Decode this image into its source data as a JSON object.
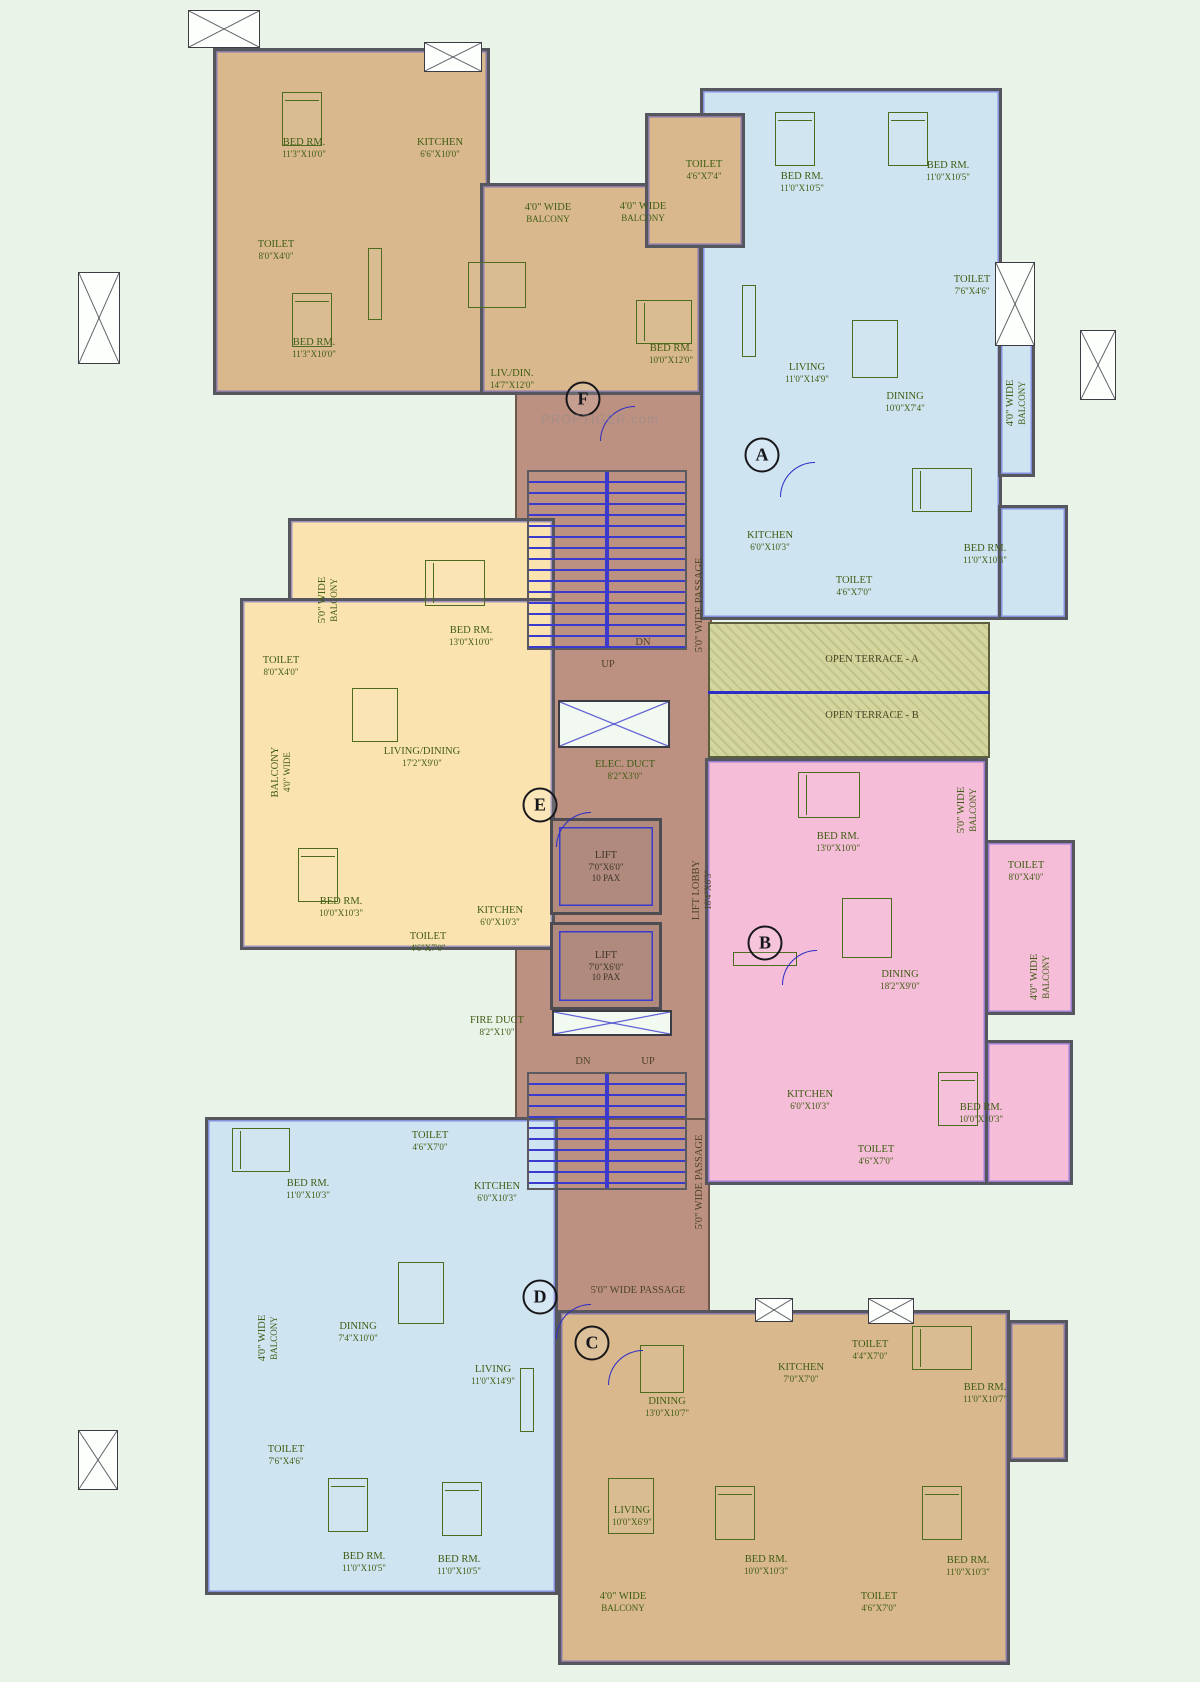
{
  "watermark": "PROPTIGER.com",
  "terraces": {
    "t1": "OPEN TERRACE - A",
    "t2": "OPEN TERRACE - B"
  },
  "core": {
    "passage": "5'0\" WIDE PASSAGE",
    "up": "UP",
    "dn": "DN",
    "lift": {
      "n": "LIFT",
      "d": "7'0\"X6'0\"",
      "c": "10 PAX"
    },
    "lift_lobby": {
      "n": "LIFT LOBBY",
      "d": "18'4\"X6'3\""
    },
    "elec_duct": {
      "n": "ELEC. DUCT",
      "d": "8'2\"X3'0\""
    },
    "fire_duct": {
      "n": "FIRE DUCT",
      "d": "8'2\"X1'0\""
    }
  },
  "units": {
    "a": {
      "letter": "A",
      "rooms": {
        "bed1": {
          "n": "BED RM.",
          "d": "11'0\"X10'5\""
        },
        "bed2": {
          "n": "BED RM.",
          "d": "11'0\"X10'5\""
        },
        "toilet1": {
          "n": "TOILET",
          "d": "7'6\"X4'6\""
        },
        "living": {
          "n": "LIVING",
          "d": "11'0\"X14'9\""
        },
        "dining": {
          "n": "DINING",
          "d": "10'0\"X7'4\""
        },
        "balcony": {
          "n": "4'0\" WIDE",
          "d": "BALCONY"
        },
        "kitchen": {
          "n": "KITCHEN",
          "d": "6'0\"X10'3\""
        },
        "toilet2": {
          "n": "TOILET",
          "d": "4'6\"X7'0\""
        },
        "bed3": {
          "n": "BED RM.",
          "d": "11'0\"X10'3\""
        }
      }
    },
    "b": {
      "letter": "B",
      "rooms": {
        "bed1": {
          "n": "BED RM.",
          "d": "13'0\"X10'0\""
        },
        "balcony1": {
          "n": "5'0\" WIDE",
          "d": "BALCONY"
        },
        "toilet1": {
          "n": "TOILET",
          "d": "8'0\"X4'0\""
        },
        "dining": {
          "n": "DINING",
          "d": "18'2\"X9'0\""
        },
        "balcony2": {
          "n": "4'0\" WIDE",
          "d": "BALCONY"
        },
        "kitchen": {
          "n": "KITCHEN",
          "d": "6'0\"X10'3\""
        },
        "toilet2": {
          "n": "TOILET",
          "d": "4'6\"X7'0\""
        },
        "bed2": {
          "n": "BED RM.",
          "d": "10'0\"X10'3\""
        }
      }
    },
    "c": {
      "letter": "C",
      "rooms": {
        "dining": {
          "n": "DINING",
          "d": "13'0\"X10'7\""
        },
        "kitchen": {
          "n": "KITCHEN",
          "d": "7'0\"X7'0\""
        },
        "toilet1": {
          "n": "TOILET",
          "d": "4'4\"X7'0\""
        },
        "bed1": {
          "n": "BED RM.",
          "d": "11'0\"X10'7\""
        },
        "living": {
          "n": "LIVING",
          "d": "10'0\"X6'9\""
        },
        "balcony": {
          "n": "4'0\" WIDE",
          "d": "BALCONY"
        },
        "bed2": {
          "n": "BED RM.",
          "d": "10'0\"X10'3\""
        },
        "toilet2": {
          "n": "TOILET",
          "d": "4'6\"X7'0\""
        },
        "bed3": {
          "n": "BED RM.",
          "d": "11'0\"X10'3\""
        }
      }
    },
    "d": {
      "letter": "D",
      "rooms": {
        "bed1": {
          "n": "BED RM.",
          "d": "11'0\"X10'3\""
        },
        "toilet1": {
          "n": "TOILET",
          "d": "4'6\"X7'0\""
        },
        "kitchen": {
          "n": "KITCHEN",
          "d": "6'0\"X10'3\""
        },
        "dining": {
          "n": "DINING",
          "d": "7'4\"X10'0\""
        },
        "balcony": {
          "n": "4'0\" WIDE",
          "d": "BALCONY"
        },
        "living": {
          "n": "LIVING",
          "d": "11'0\"X14'9\""
        },
        "toilet2": {
          "n": "TOILET",
          "d": "7'6\"X4'6\""
        },
        "bed2": {
          "n": "BED RM.",
          "d": "11'0\"X10'5\""
        },
        "bed3": {
          "n": "BED RM.",
          "d": "11'0\"X10'5\""
        }
      }
    },
    "e": {
      "letter": "E",
      "rooms": {
        "balcony1": {
          "n": "5'0\" WIDE",
          "d": "BALCONY"
        },
        "toilet1": {
          "n": "TOILET",
          "d": "8'0\"X4'0\""
        },
        "bed1": {
          "n": "BED RM.",
          "d": "13'0\"X10'0\""
        },
        "livdin": {
          "n": "LIVING/DINING",
          "d": "17'2\"X9'0\""
        },
        "balcony2": {
          "n": "BALCONY",
          "d": "4'0\" WIDE"
        },
        "bed2": {
          "n": "BED RM.",
          "d": "10'0\"X10'3\""
        },
        "kitchen": {
          "n": "KITCHEN",
          "d": "6'0\"X10'3\""
        },
        "toilet2": {
          "n": "TOILET",
          "d": "4'6\"X7'0\""
        }
      }
    },
    "f": {
      "letter": "F",
      "rooms": {
        "bed1": {
          "n": "BED RM.",
          "d": "11'3\"X10'0\""
        },
        "kitchen": {
          "n": "KITCHEN",
          "d": "6'6\"X10'0\""
        },
        "toilet1": {
          "n": "TOILET",
          "d": "8'0\"X4'0\""
        },
        "bed2": {
          "n": "BED RM.",
          "d": "11'3\"X10'0\""
        },
        "livdin": {
          "n": "LIV./DIN.",
          "d": "14'7\"X12'0\""
        },
        "balcony1": {
          "n": "4'0\" WIDE",
          "d": "BALCONY"
        },
        "balcony2": {
          "n": "4'0\" WIDE",
          "d": "BALCONY"
        },
        "toilet2": {
          "n": "TOILET",
          "d": "4'6\"X7'4\""
        },
        "bed3": {
          "n": "BED RM.",
          "d": "10'0\"X12'0\""
        }
      }
    }
  },
  "colors": {
    "tan": "#d8b88c",
    "blue": "#cfe4f1",
    "pink": "#f5bdd7",
    "peach": "#fbe3b0",
    "core": "#bd9181",
    "terrace": "#d3d69e",
    "wall": "#55565e",
    "ink": "#405d14",
    "blueline": "#2d2dc8",
    "bg": "#e9f3e7"
  }
}
